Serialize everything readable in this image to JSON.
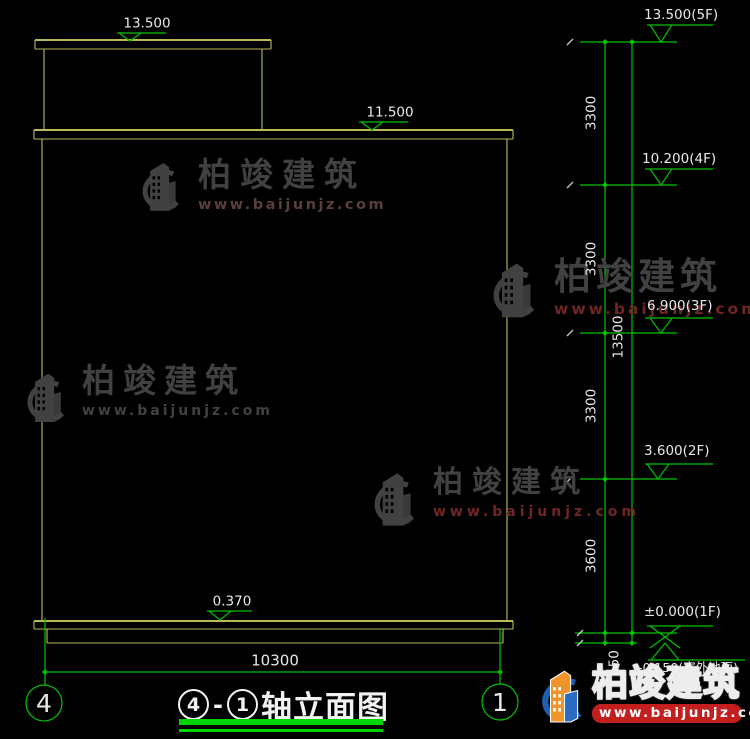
{
  "colors": {
    "bg": "#000000",
    "cad-yellow": "#b9b95a",
    "cad-green": "#00c300",
    "cad-white": "#e9e9e9",
    "wm-gray": "#414141",
    "wm-red": "#702525",
    "wm-gray-red": "#5a3e3e",
    "logo-blue": "#1d5fb5",
    "logo-orange": "#f0942a",
    "badge-red": "#c41f1f",
    "title-green": "#00d400"
  },
  "markers": {
    "penthouse_roof": "13.500",
    "main_roof": "11.500",
    "plinth": "0.370"
  },
  "levels": [
    {
      "label": "13.500(5F)"
    },
    {
      "label": "10.200(4F)"
    },
    {
      "label": "6.900(3F)"
    },
    {
      "label": "3.600(2F)"
    },
    {
      "label": "±0.000(1F)"
    },
    {
      "label": "-0.150(室外地面)"
    }
  ],
  "vdims": [
    "3300",
    "3300",
    "3300",
    "3600",
    "150"
  ],
  "overall_dim": "13500",
  "width_dim": "10300",
  "axis_bubbles": {
    "left": "4",
    "right": "1"
  },
  "title": {
    "axis_left": "4",
    "separator": "-",
    "axis_right": "1",
    "text": "轴立面图"
  },
  "watermark": {
    "brand": "柏竣建筑",
    "url": "www.baijunjz.com"
  },
  "logo": {
    "brand": "柏竣建筑",
    "url": "www.baijunjz.com"
  }
}
